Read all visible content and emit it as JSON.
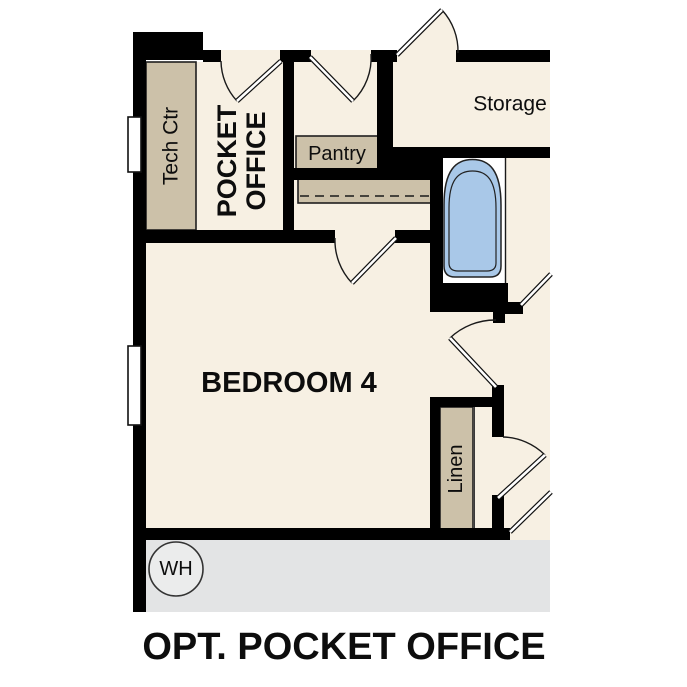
{
  "plan": {
    "caption": "OPT. POCKET OFFICE",
    "labels": {
      "tech_ctr": "Tech Ctr",
      "pocket_office_line1": "POCKET",
      "pocket_office_line2": "OFFICE",
      "pantry": "Pantry",
      "storage": "Storage",
      "bedroom": "BEDROOM 4",
      "linen": "Linen",
      "water_heater": "WH"
    },
    "colors": {
      "wall": "#000000",
      "room_fill": "#f7f0e3",
      "cabinet_fill": "#ccc1a9",
      "tub_fill": "#a9c8e8",
      "garage_fill": "#e3e4e5",
      "wh_fill": "#ebecec"
    }
  }
}
